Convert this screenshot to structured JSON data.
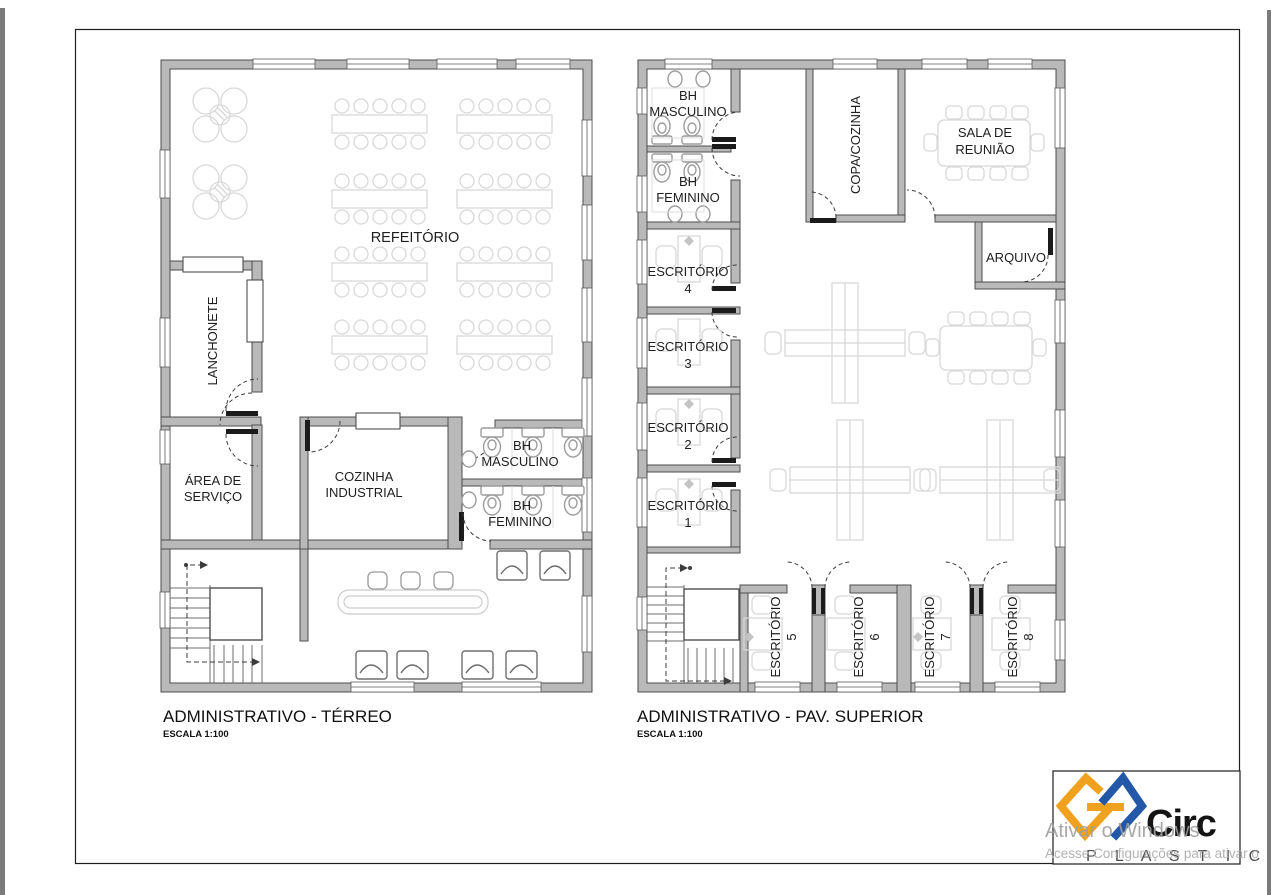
{
  "plans": {
    "terreo": {
      "title": "ADMINISTRATIVO - TÉRREO",
      "scale_label": "ESCALA 1:100",
      "rooms": {
        "refeitorio": "REFEITÓRIO",
        "lanchonete": "LANCHONETE",
        "area_servico": [
          "ÁREA DE",
          "SERVIÇO"
        ],
        "cozinha_industrial": [
          "COZINHA",
          "INDUSTRIAL"
        ],
        "bh_masculino": [
          "BH",
          "MASCULINO"
        ],
        "bh_feminino": [
          "BH",
          "FEMININO"
        ]
      }
    },
    "superior": {
      "title": "ADMINISTRATIVO - PAV. SUPERIOR",
      "scale_label": "ESCALA 1:100",
      "rooms": {
        "bh_masculino": [
          "BH",
          "MASCULINO"
        ],
        "bh_feminino": [
          "BH",
          "FEMININO"
        ],
        "escritorio_4": [
          "ESCRITÓRIO",
          "4"
        ],
        "escritorio_3": [
          "ESCRITÓRIO",
          "3"
        ],
        "escritorio_2": [
          "ESCRITÓRIO",
          "2"
        ],
        "escritorio_1": [
          "ESCRITÓRIO",
          "1"
        ],
        "copa_cozinha": "COPA/COZINHA",
        "sala_reuniao": [
          "SALA DE",
          "REUNIÃO"
        ],
        "arquivo": "ARQUIVO",
        "escritorio_5": [
          "ESCRITÓRIO",
          "5"
        ],
        "escritorio_6": [
          "ESCRITÓRIO",
          "6"
        ],
        "escritorio_7": [
          "ESCRITÓRIO",
          "7"
        ],
        "escritorio_8": [
          "ESCRITÓRIO",
          "8"
        ]
      }
    }
  },
  "logo": {
    "name": "Circ",
    "subname": "P L A S T I C",
    "orange": "#F0A21E",
    "blue": "#2358A8"
  },
  "watermark": {
    "line1": "Ativar o Windows",
    "line2": "Acesse Configurações para ativar o",
    "color": "#9E9E9E"
  },
  "colors": {
    "wall_fill": "#B9B9B9",
    "wall_stroke": "#4D4D4D",
    "furniture_light": "#D8D8D8",
    "fixture_gray": "#9C9C9C",
    "text": "#1E1E1E"
  }
}
